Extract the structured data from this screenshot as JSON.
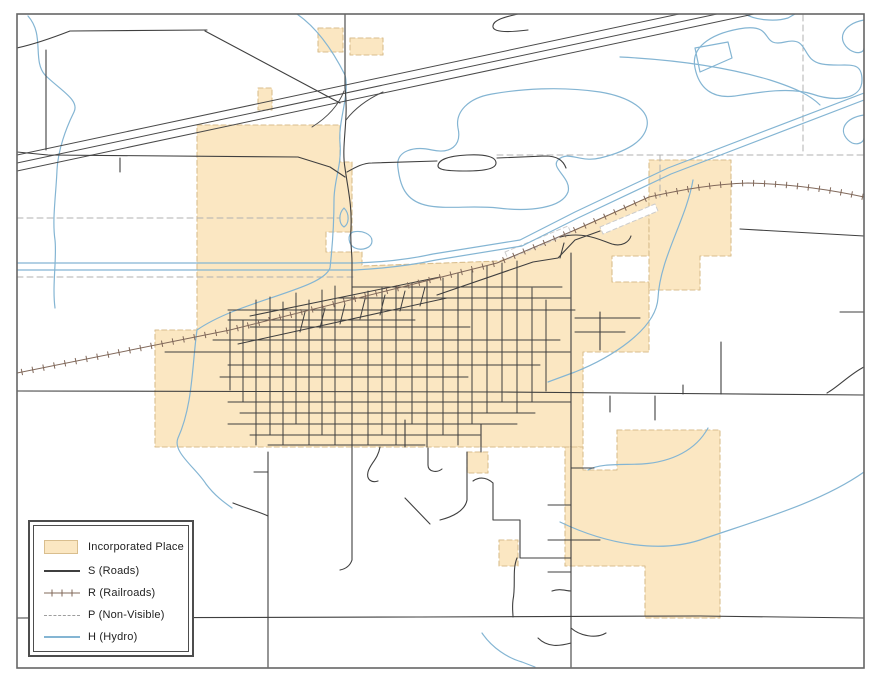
{
  "canvas": {
    "width": 881,
    "height": 683,
    "background": "#FFFFFF"
  },
  "legend": {
    "items": [
      {
        "id": "incorporated-place",
        "label": "Incorporated Place",
        "symbol": "area",
        "fill": "#FBE7C2",
        "border": "#D9BE8E"
      },
      {
        "id": "roads",
        "label": "S (Roads)",
        "symbol": "line",
        "color": "#3F3F3F"
      },
      {
        "id": "railroads",
        "label": "R (Railroads)",
        "symbol": "railroad",
        "color": "#80685A"
      },
      {
        "id": "non-visible",
        "label": "P (Non-Visible)",
        "symbol": "dashed",
        "color": "#9E9E9E"
      },
      {
        "id": "hydro",
        "label": "H (Hydro)",
        "symbol": "line",
        "color": "#84B5D3"
      }
    ]
  },
  "map": {
    "frame": {
      "x": 17,
      "y": 14,
      "w": 847,
      "h": 654,
      "stroke": "#666666",
      "width": 1.6
    },
    "grid": {
      "h": [
        [
          287,
          352,
          562
        ],
        [
          298,
          338,
          570
        ],
        [
          310,
          228,
          575
        ],
        [
          320,
          228,
          415
        ],
        [
          327,
          250,
          470
        ],
        [
          340,
          213,
          560
        ],
        [
          352,
          165,
          570
        ],
        [
          365,
          228,
          540
        ],
        [
          377,
          220,
          468
        ],
        [
          402,
          228,
          571
        ],
        [
          413,
          240,
          535
        ],
        [
          424,
          228,
          517
        ],
        [
          435,
          250,
          480
        ],
        [
          445,
          268,
          425
        ]
      ],
      "v": [
        [
          230,
          312,
          390
        ],
        [
          243,
          320,
          402
        ],
        [
          256,
          300,
          445
        ],
        [
          270,
          297,
          435
        ],
        [
          283,
          302,
          445
        ],
        [
          296,
          293,
          424
        ],
        [
          309,
          300,
          445
        ],
        [
          322,
          290,
          435
        ],
        [
          335,
          286,
          445
        ],
        [
          368,
          291,
          445
        ],
        [
          382,
          288,
          435
        ],
        [
          396,
          286,
          445
        ],
        [
          412,
          283,
          424
        ],
        [
          427,
          281,
          447
        ],
        [
          443,
          278,
          435
        ],
        [
          458,
          273,
          445
        ],
        [
          472,
          269,
          424
        ],
        [
          487,
          266,
          413
        ],
        [
          502,
          263,
          402
        ],
        [
          517,
          261,
          413
        ],
        [
          532,
          288,
          402
        ],
        [
          546,
          300,
          391
        ]
      ],
      "diag": [
        [
          250,
          316,
          440,
          277
        ],
        [
          238,
          344,
          447,
          298
        ],
        [
          300,
          332,
          305,
          312
        ],
        [
          320,
          328,
          325,
          308
        ],
        [
          340,
          324,
          345,
          304
        ],
        [
          360,
          319,
          365,
          299
        ],
        [
          380,
          315,
          385,
          295
        ],
        [
          400,
          311,
          405,
          291
        ],
        [
          420,
          306,
          425,
          287
        ]
      ]
    },
    "layers": [
      {
        "name": "incorporated-places",
        "kind": "area",
        "fill": "#FBE7C2",
        "stroke": "#D9BE8E",
        "dash": "5,3",
        "width": 1.1,
        "paths": [
          "M318,28 H343 V52 H318 Z",
          "M350,38 H383 V55 H350 Z",
          "M258,88 H272 V110 H258 Z",
          "M197,125 H340 V162 H352 V232 H326 V252 H362 V266 L500,261 L575,230 L649,197 V256 H612 V282 H649 V352 H583 V447 H155 V330 H197 Z",
          "M649,160 H731 V256 H700 V290 H649 Z",
          "M617,430 H720 V618 H645 V566 H565 V447 H583 V470 H617 Z",
          "M467,452 H488 V473 H467 Z",
          "M499,540 H518 V566 H499 Z"
        ]
      },
      {
        "name": "railroad-notches",
        "kind": "area",
        "fill": "#FFFFFF",
        "stroke": "#CCCCCC",
        "dash": "4,3",
        "width": 1,
        "paths": [
          "M600,227 L655,204 L658,211 L603,234 Z",
          "M505,252 L568,226 L571,233 L508,259 Z"
        ]
      },
      {
        "name": "nonvisible-boundaries",
        "kind": "stroke",
        "stroke": "#B0B0B0",
        "dash": "6,4",
        "width": 1,
        "paths": [
          "M17,218 H340",
          "M17,277 H355",
          "M497,155 H864",
          "M803,15 V155",
          "M660,155 V197"
        ]
      },
      {
        "name": "hydro",
        "kind": "stroke",
        "stroke": "#84B5D3",
        "width": 1.2,
        "paths": [
          "M17,263 H355 C390,262 415,258 433,254 L520,240 L575,212 L668,168 L864,93",
          "M17,270 H355 C392,268 417,264 436,260 L522,246 L578,218 L671,174 L864,100",
          "M28,16 C45,35 32,60 45,75 C60,90 80,100 74,112 C66,128 58,150 57,170 C56,195 52,220 55,240 C57,258 52,285 55,308",
          "M297,14 C320,30 335,55 345,75 C350,95 338,120 340,143 C342,165 334,180 334,200 C334,230 332,250 330,268 C322,290 240,300 197,330 C192,365 193,405 178,438 C172,452 196,468 206,484 C215,496 225,503 232,508",
          "M693,180 C686,220 660,258 658,298 C656,330 610,358 575,372 L548,382",
          "M708,428 C696,450 672,462 642,464 C622,465 600,463 588,470",
          "M560,522 C608,545 660,553 700,540 C758,520 820,503 864,472",
          "M482,633 C492,648 508,658 522,662 L535,667",
          "M398,168 C395,150 415,146 432,150 C450,154 462,146 458,128 C455,112 468,98 492,94 C520,89 560,86 600,92 C630,97 650,110 647,126 C644,142 625,152 600,158 C580,163 568,150 558,160 C550,168 572,178 568,192 C562,208 530,212 498,208 C470,205 445,210 425,205 C405,200 400,185 398,168 Z",
          "M695,68 C690,45 715,32 745,28 C775,25 760,48 785,42 C810,36 800,60 822,64 C845,68 862,58 862,80 C862,100 835,102 812,94 C790,87 760,92 735,96 C712,99 699,88 695,68 Z",
          "M745,14 C755,20 775,22 788,18 L795,14",
          "M695,48 L728,42 L732,58 L700,72 Z",
          "M620,57 C680,60 730,68 770,80 C795,88 810,95 820,105",
          "M864,20 C842,24 836,40 850,50 C858,55 864,52 864,48",
          "M864,115 C845,118 838,130 848,140 C855,147 864,143 864,138",
          "M353,232 C362,230 372,234 372,241 C372,248 362,251 355,248 C348,245 347,234 353,232 Z",
          "M344,208 C350,214 349,224 344,227 C339,224 338,214 344,208 Z"
        ]
      },
      {
        "name": "highway",
        "kind": "stroke",
        "stroke": "#4A4A4A",
        "width": 1,
        "paths": [
          "M17,155 L679,14",
          "M17,163 L717,14",
          "M17,171 L754,14",
          "M312,127 Q336,112 344,91",
          "M346,120 Q359,103 383,92"
        ]
      },
      {
        "name": "roads",
        "kind": "stroke",
        "stroke": "#3F3F3F",
        "width": 1.1,
        "paths": [
          "M17,48 C35,44 52,38 70,31 L207,30",
          "M205,31 L340,103",
          "M46,50 V150",
          "M17,152 L48,155 L298,157 L330,167 L345,177",
          "M120,158 V172",
          "M518,14 C505,17 492,20 493,27 C494,33 512,32 528,30",
          "M345,14 V88",
          "M345,88 C349,120 341,145 345,168 C348,190 352,205 351,228 C350,243 352,250 352,262",
          "M352,262 V420",
          "M347,172 C356,167 363,163 372,163 L437,161",
          "M497,158 L545,156 C557,156 563,160 566,168",
          "M438,166 C438,160 448,156 467,155 C486,154 496,157 496,163 C496,169 484,171 466,171 C448,171 438,170 438,166 Z",
          "M17,391 L500,392 L864,395",
          "M17,618 L420,617 L700,616 L864,618",
          "M268,452 V667",
          "M233,503 C248,509 260,512 268,516",
          "M268,472 H254",
          "M571,253 V667",
          "M571,468 H594",
          "M548,505 H571",
          "M548,540 H600",
          "M548,572 H571",
          "M552,591 C560,588 566,591 571,591",
          "M571,628 C580,636 596,639 606,633",
          "M538,638 C548,648 560,646 571,643",
          "M721,342 V394",
          "M683,385 V394",
          "M610,396 V412",
          "M655,396 V420",
          "M864,367 C850,374 838,387 827,393",
          "M840,312 H864",
          "M740,229 L864,236",
          "M437,295 L533,262 L558,258 L575,240 L600,231",
          "M560,258 L564,243",
          "M560,237 C584,231 600,240 612,244 C622,247 629,242 631,236",
          "M352,420 V560 C350,566 345,569 340,570",
          "M380,447 C378,459 370,464 368,472 C366,480 372,483 378,481",
          "M405,420 V447",
          "M428,448 V465 C428,472 437,473 442,469",
          "M467,452 V500 C465,511 452,517 440,520",
          "M481,424 V452",
          "M405,498 L430,524",
          "M493,483 V520 H520 V558 H571",
          "M493,483 C486,477 479,477 473,481",
          "M517,558 C512,570 516,585 513,600 C512,608 513,613 513,617",
          "M575,318 H640",
          "M575,332 H625",
          "M600,312 V350"
        ]
      },
      {
        "name": "railroad",
        "kind": "railroad",
        "stroke": "#80685A",
        "width": 1,
        "tick": 3.2,
        "spacing": 11,
        "paths": [
          "M17,373 L230,330 L402,287 L497,263 L575,230 L649,197 C685,189 715,184 748,183 C795,184 832,190 864,197"
        ]
      }
    ]
  }
}
